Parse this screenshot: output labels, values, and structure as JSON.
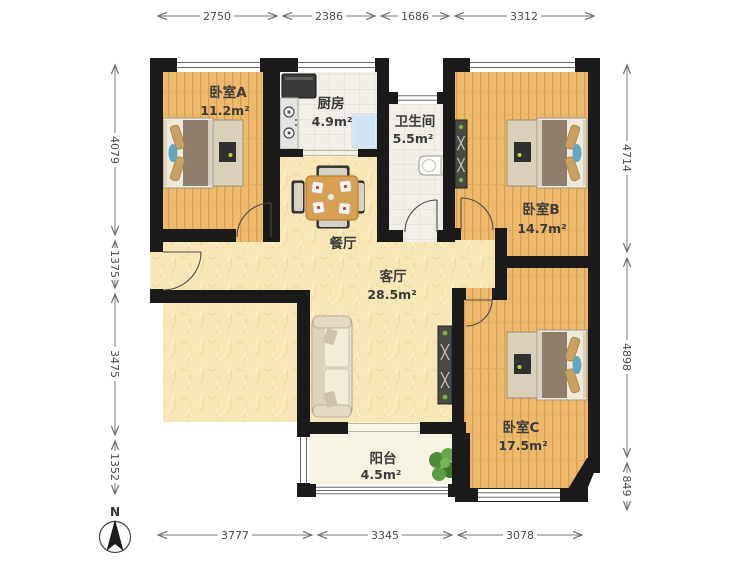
{
  "floorplan": {
    "compass_label": "N",
    "rooms": {
      "bedroomA": {
        "name": "卧室A",
        "area": "11.2m²"
      },
      "kitchen": {
        "name": "厨房",
        "area": "4.9m²"
      },
      "bathroom": {
        "name": "卫生间",
        "area": "5.5m²"
      },
      "bedroomB": {
        "name": "卧室B",
        "area": "14.7m²"
      },
      "dining": {
        "name": "餐厅",
        "area": ""
      },
      "living": {
        "name": "客厅",
        "area": "28.5m²"
      },
      "bedroomC": {
        "name": "卧室C",
        "area": "17.5m²"
      },
      "balcony": {
        "name": "阳台",
        "area": "4.5m²"
      }
    },
    "dimensions_mm": {
      "top": [
        "2750",
        "2386",
        "1686",
        "3312"
      ],
      "bottom": [
        "3777",
        "3345",
        "3078"
      ],
      "left": [
        "4079",
        "1375",
        "3475",
        "1352"
      ],
      "right": [
        "4714",
        "4898",
        "849"
      ]
    },
    "colors": {
      "wall": "#1a1a1a",
      "wood_floor": "#edb96c",
      "public_floor": "#f7e6b6",
      "tile_floor": "#f1efe8",
      "balcony_floor": "#f6f3e2",
      "plant_green": "#579038",
      "bed_blue": "#5fa8c4"
    }
  }
}
